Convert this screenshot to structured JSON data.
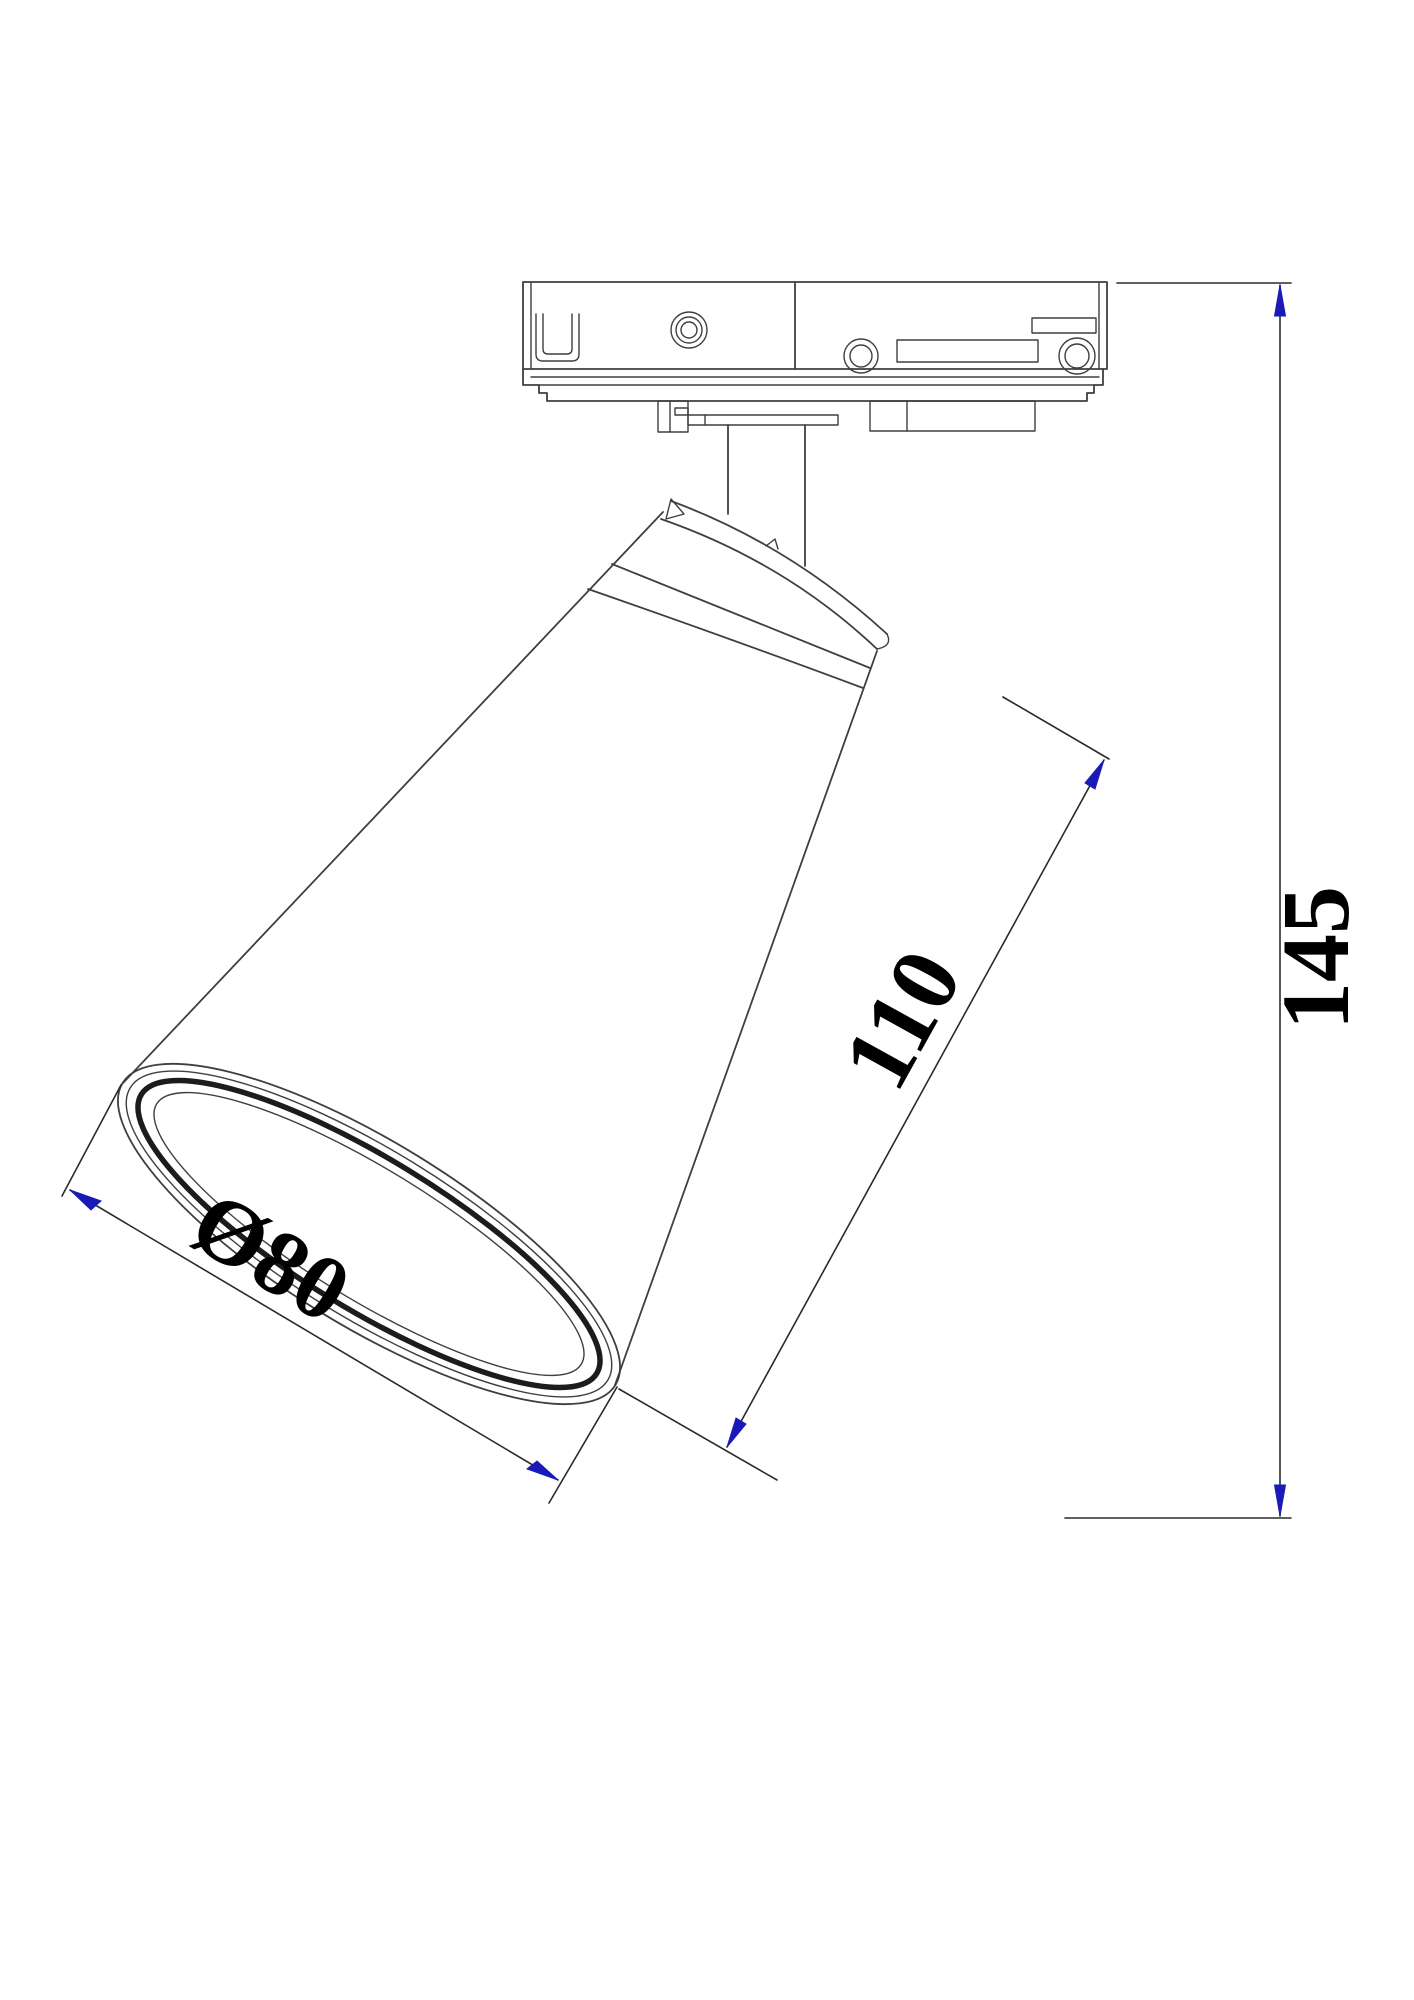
{
  "figure": {
    "type": "technical-drawing",
    "subject": "Track-mounted spotlight with conical shade, side elevation with dimensions",
    "background": "#ffffff",
    "colors": {
      "line": "#3f3f3f",
      "dimension_line": "#2b2b2b",
      "arrow": "#1a1ab8",
      "text": "#000000"
    },
    "parts": [
      "track-adapter",
      "mounting-plates",
      "stem",
      "shade-neck",
      "shade-band",
      "shade-cone",
      "opening-rim"
    ]
  },
  "dimensions": [
    {
      "id": "total-height",
      "label": "145",
      "orientation": "vertical",
      "location": "right side"
    },
    {
      "id": "shade-length",
      "label": "110",
      "orientation": "diagonal",
      "location": "right of shade"
    },
    {
      "id": "opening-diameter",
      "label": "Ø80",
      "orientation": "diagonal",
      "location": "bottom left of opening"
    }
  ]
}
